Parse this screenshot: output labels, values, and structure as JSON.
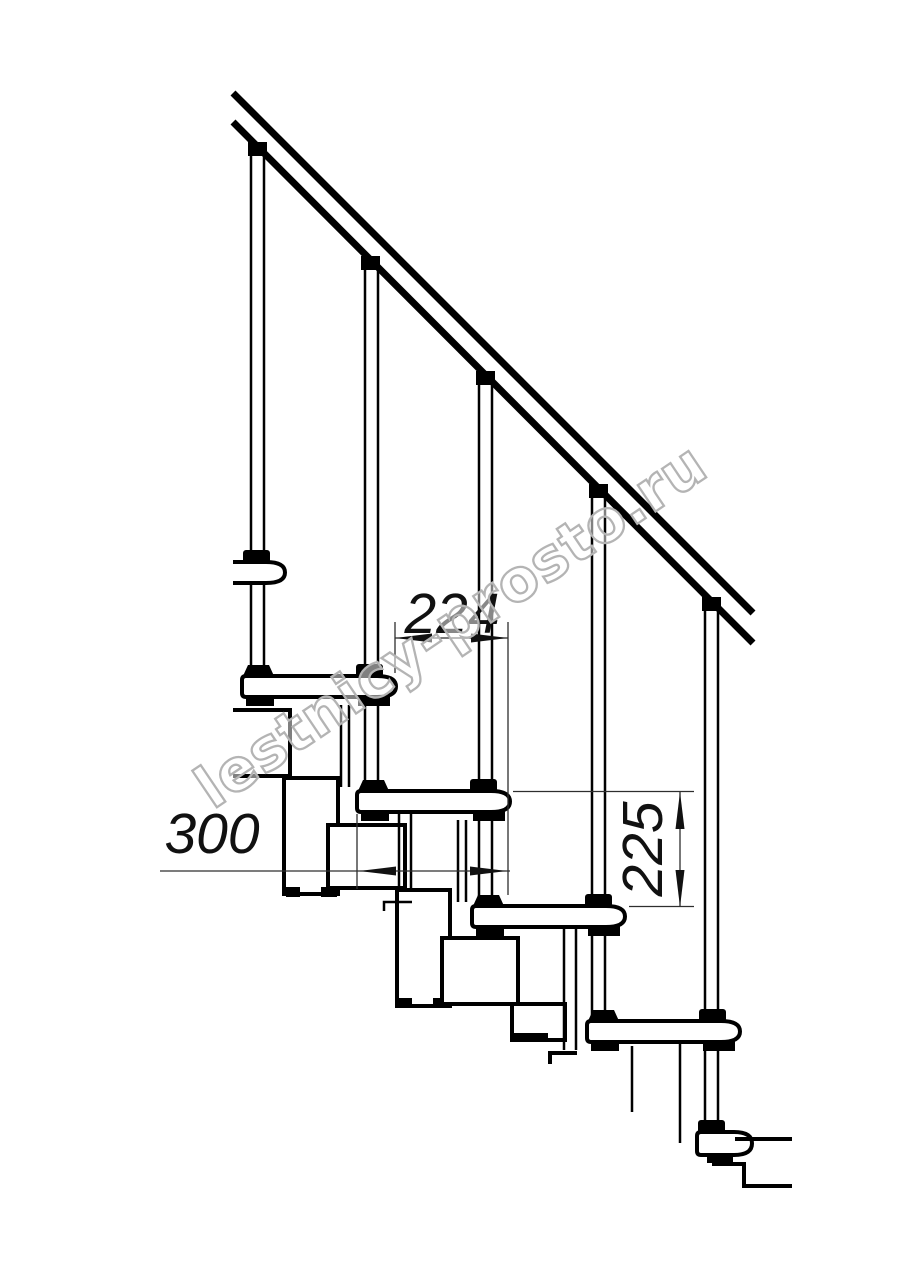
{
  "drawing": {
    "type": "staircase-fragment-technical-drawing",
    "watermark": "lestnicy-prosto.ru",
    "dimensions": {
      "going": "224",
      "tread_depth": "300",
      "riser_height": "225"
    },
    "colors": {
      "line": "#000000",
      "dimension_line": "#2e2e2e",
      "watermark": "#b4b4b4",
      "background": "#ffffff"
    }
  }
}
